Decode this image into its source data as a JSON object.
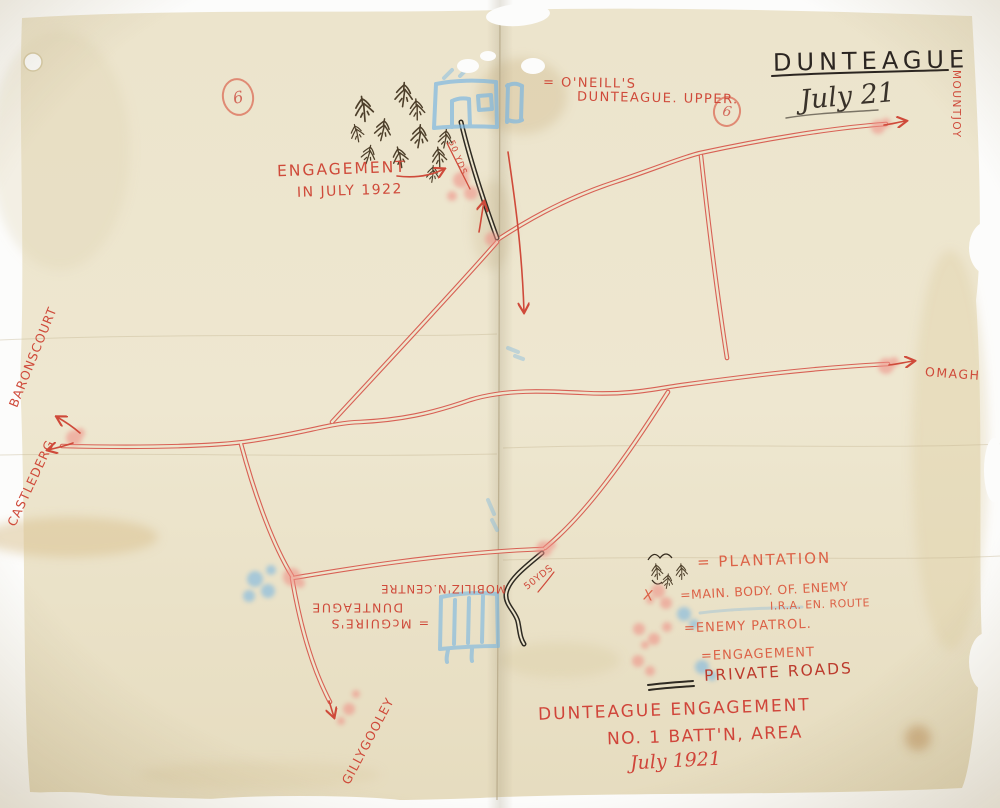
{
  "header": {
    "title": "DUNTEAGUE",
    "date": "July 21",
    "page_mark_left": "6",
    "page_mark_right": "6"
  },
  "map_labels": {
    "oneills_line1": "= O'NEILL'S",
    "oneills_line2": "DUNTEAGUE. UPPER.",
    "engagement_line1": "ENGAGEMENT",
    "engagement_line2": "IN JULY 1922",
    "distance_upper": "50 YDS",
    "distance_lower": "50YDS",
    "mountjoy": "MOUNTJOY",
    "omagh": "OMAGH",
    "baronscourt": "BARONSCOURT",
    "castlederg": "CASTLEDERG",
    "gillygooley": "GILLYGOOLEY",
    "mcguires_line1": "= McGUIRE'S",
    "mcguires_line2": "DUNTEAGUE",
    "mobilization": "MOBILIZ'N.CENTRE"
  },
  "legend": {
    "x_mark": "X",
    "items": [
      {
        "symbol": "plantation",
        "label": "= PLANTATION"
      },
      {
        "symbol": "main-body-of-enemy",
        "label": "=MAIN. BODY. OF. ENEMY"
      },
      {
        "symbol": "ira-en-route",
        "label": "I.R.A. EN. ROUTE"
      },
      {
        "symbol": "enemy-patrol",
        "label": "=ENEMY PATROL."
      },
      {
        "symbol": "engagement",
        "label": "=ENGAGEMENT"
      },
      {
        "symbol": "private-roads",
        "label": "PRIVATE ROADS"
      }
    ]
  },
  "footer": {
    "line1": "DUNTEAGUE ENGAGEMENT",
    "line2": "NO. 1 BATT'N, AREA",
    "line3": "July 1921"
  },
  "colors": {
    "red_ink": "#cf4a3a",
    "dark_ink": "#2b2521",
    "pink_crayon": "#ef9288",
    "blue_crayon": "#6fb2e4",
    "paper": "#ece4cc"
  }
}
